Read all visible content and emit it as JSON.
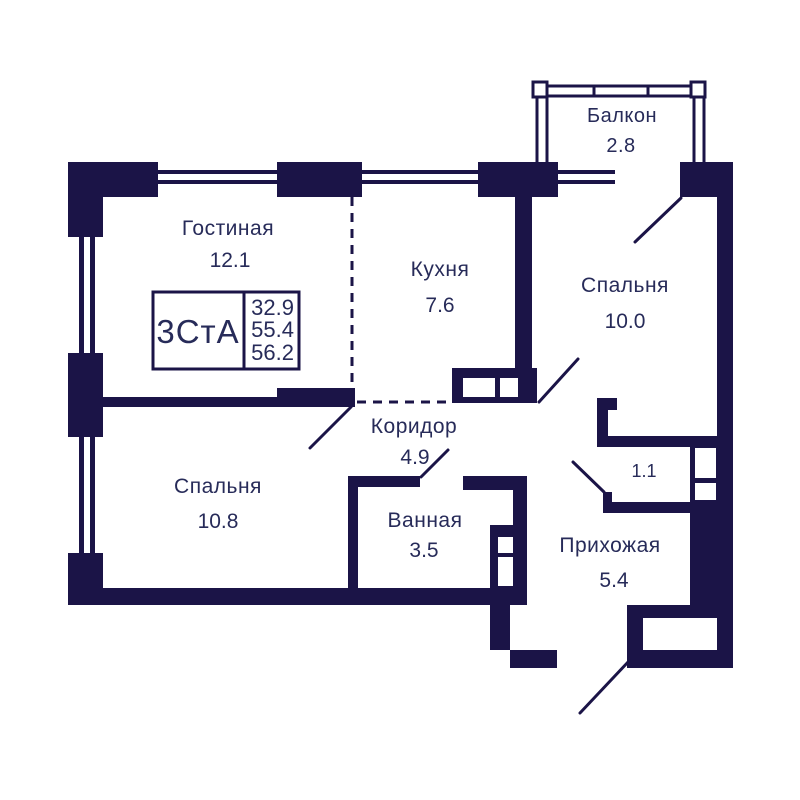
{
  "plan": {
    "unit_code": "3СтА",
    "stats": {
      "living_area": "32.9",
      "area_without_balcony": "55.4",
      "total_area": "56.2"
    },
    "rooms": {
      "living": {
        "name": "Гостиная",
        "area": "12.1"
      },
      "kitchen": {
        "name": "Кухня",
        "area": "7.6"
      },
      "bedroom1": {
        "name": "Спальня",
        "area": "10.0"
      },
      "bedroom2": {
        "name": "Спальня",
        "area": "10.8"
      },
      "corridor": {
        "name": "Коридор",
        "area": "4.9"
      },
      "bathroom": {
        "name": "Ванная",
        "area": "3.5"
      },
      "hallway": {
        "name": "Прихожая",
        "area": "5.4"
      },
      "balcony": {
        "name": "Балкон",
        "area": "2.8"
      },
      "storage": {
        "area": "1.1"
      }
    },
    "colors": {
      "wall": "#1b1447",
      "text": "#272b59",
      "background": "#ffffff"
    }
  }
}
